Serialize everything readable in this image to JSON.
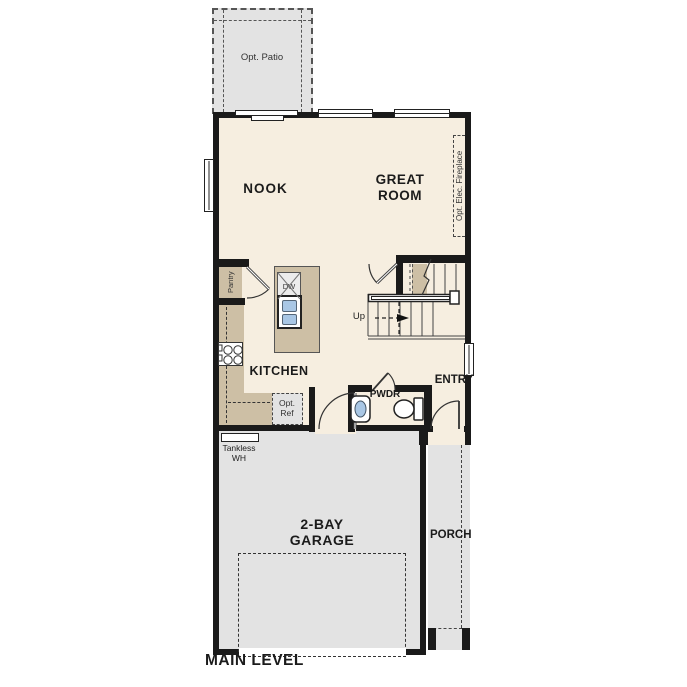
{
  "title": "MAIN LEVEL",
  "labels": {
    "main_level": "MAIN LEVEL",
    "nook": "NOOK",
    "great_room": "GREAT ROOM",
    "kitchen": "KITCHEN",
    "pwdr": "PWDR",
    "entry": "ENTRY",
    "garage": "2-BAY GARAGE",
    "porch": "PORCH",
    "opt_patio": "Opt. Patio",
    "opt_elec_fireplace": "Opt. Elec. Fireplace",
    "pantry": "Pantry",
    "dw": "DW",
    "up": "Up",
    "opt_ref": "Opt. Ref",
    "tankless_wh": "Tankless WH"
  },
  "colors": {
    "floor": "#f6eee0",
    "wall": "#1a1a1a",
    "concrete": "#e3e3e3",
    "casework": "#cdbfa5",
    "fixture_blue": "#a9c7e5",
    "appliance_gray": "#ececec",
    "line": "#444444"
  }
}
